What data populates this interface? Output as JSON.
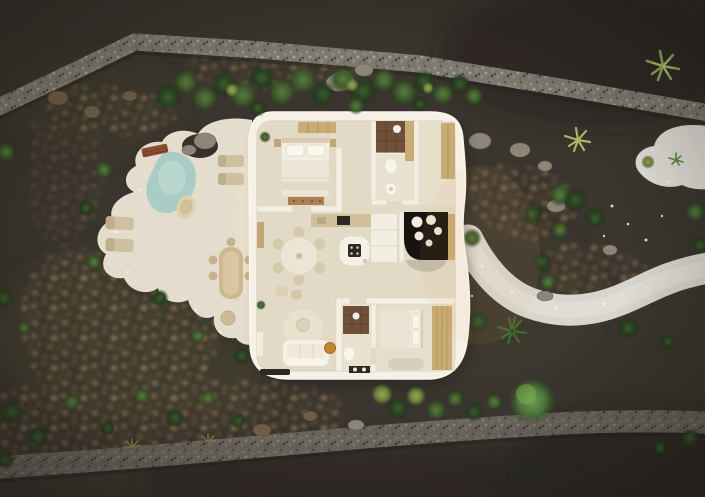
{
  "scene": {
    "type": "3d-architectural-aerial-render",
    "view": "top-down",
    "lighting": "dusk",
    "subject": "Organic-shaped white villa seen from above with roof cut away showing furnished interior, freeform white terrace with plunge pool and loungers on the left, winding light gravel path on the right, dark volcanic-soil garden bounded by stone walls with boulders and desert vegetation"
  },
  "colors": {
    "ground": "#3a352e",
    "stone_wall": "#7e7970",
    "sand_path": "#d7d5ce",
    "sand_patch": "#e2e0d9",
    "terrace": "#eae3d3",
    "pool_water": "#a9cdc4",
    "house_wall": "#f6f1e6",
    "house_floor": "#e2dac6",
    "courtyard_floor": "#17130e",
    "wood_light": "#c9ab74",
    "wood_counter": "#d2c09c",
    "shower_tile": "#6e5138",
    "dark_fixture": "#2e2822",
    "accent_pouf": "#c08433"
  },
  "landscape": {
    "features": [
      "stone boundary wall top",
      "stone boundary wall bottom",
      "rocky scatter beds",
      "white gravel path",
      "white sand clearing",
      "volcanic soil",
      "boulders",
      "shrubs",
      "agave",
      "yucca",
      "palm",
      "round tree",
      "path lights"
    ]
  },
  "house": {
    "rooms": [
      "bedroom 1",
      "bathroom 1",
      "hallway",
      "open kitchen and dining",
      "dark patio nook",
      "living room",
      "bathroom 2",
      "bedroom 2"
    ],
    "furniture": [
      "double bed",
      "wardrobe",
      "dresser",
      "walk-in shower",
      "toilet",
      "washbasin",
      "kitchen counter",
      "kitchen island with hob",
      "round dining table with chairs",
      "sofa",
      "round rug",
      "orange ottoman",
      "tv console",
      "double bed 2",
      "bedroom rug"
    ]
  },
  "terrace": {
    "items": [
      "plunge pool",
      "wooden bench",
      "sun lounger pair top",
      "sun lounger pair left",
      "lounge chair",
      "outdoor dining table with chairs",
      "round stool"
    ]
  }
}
